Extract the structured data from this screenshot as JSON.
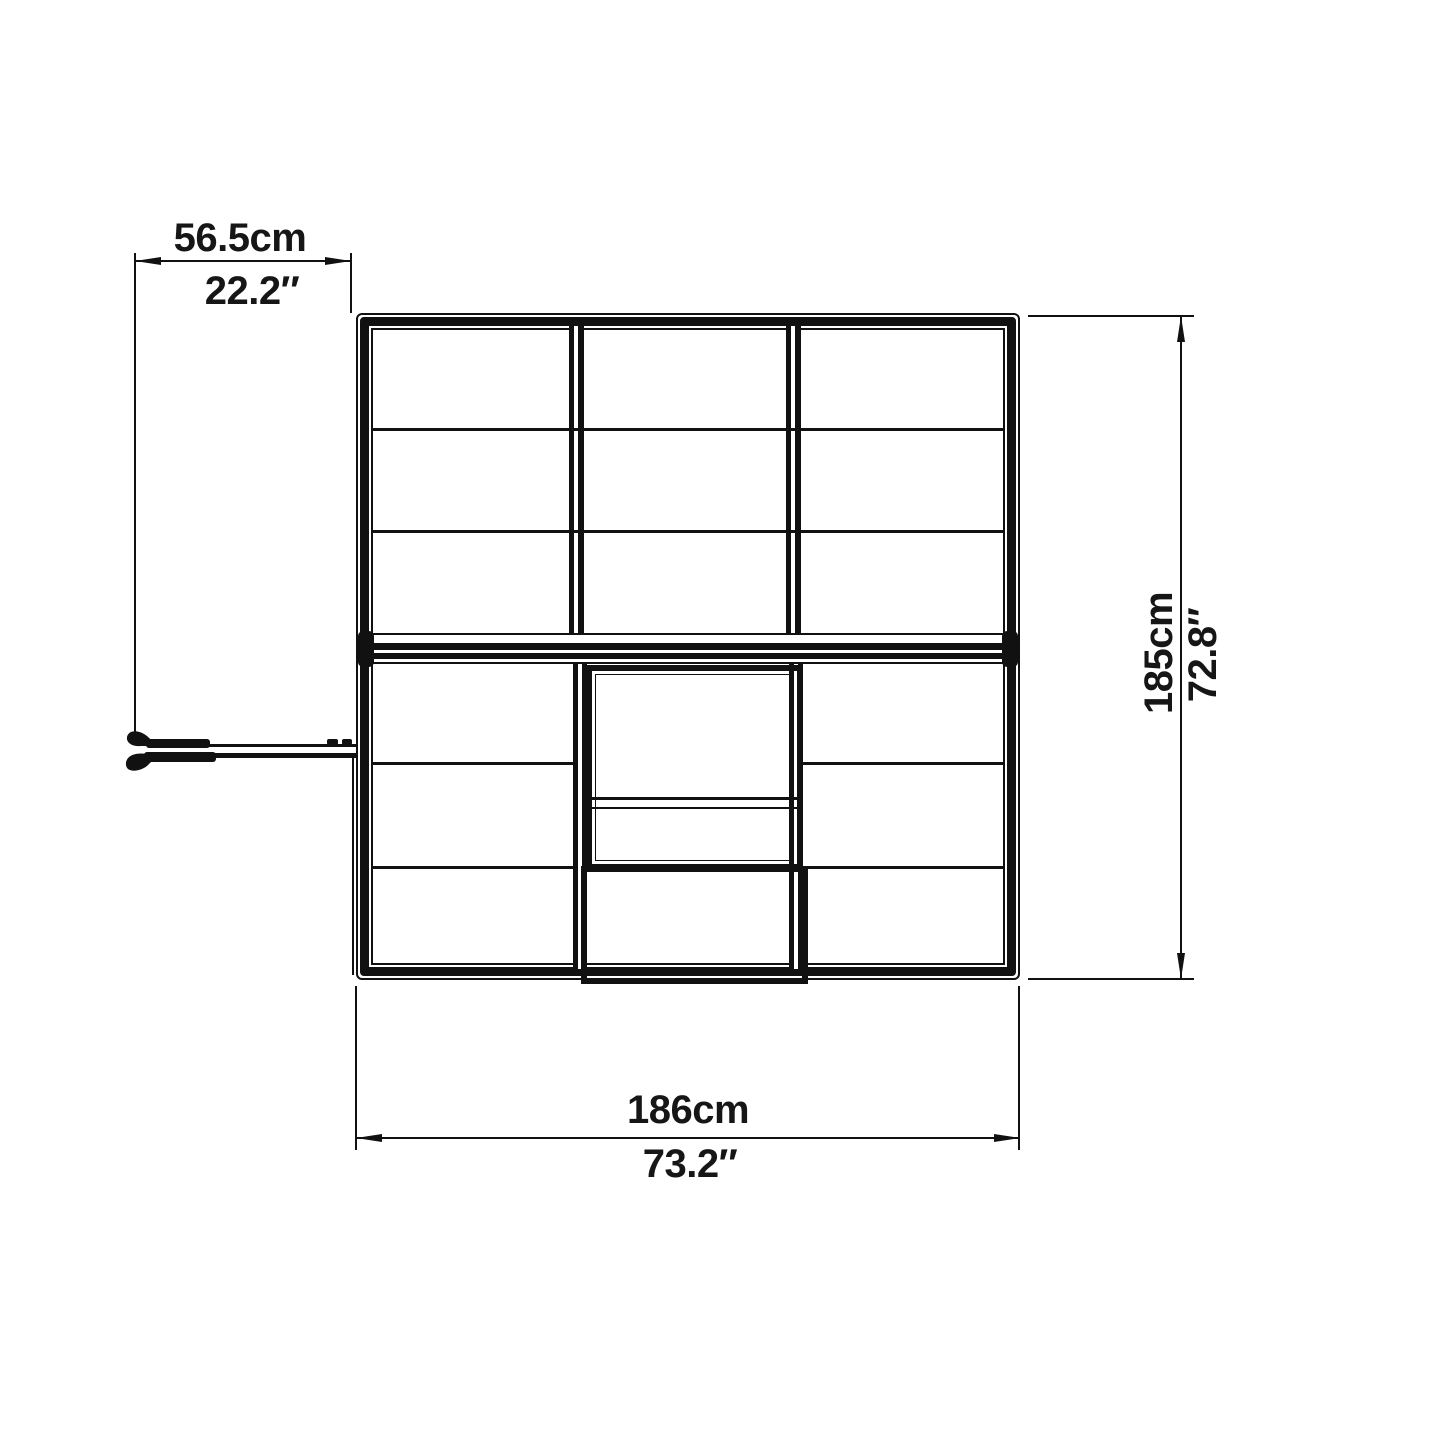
{
  "diagram": {
    "title": "greenhouse-top-view-dimension-drawing",
    "line_color": "#111111",
    "background": "#ffffff",
    "dimensions": {
      "door_width": {
        "metric": "56.5cm",
        "imperial": "22.2″"
      },
      "depth": {
        "metric": "185cm",
        "imperial": "72.8″"
      },
      "width": {
        "metric": "186cm",
        "imperial": "73.2″"
      }
    }
  }
}
